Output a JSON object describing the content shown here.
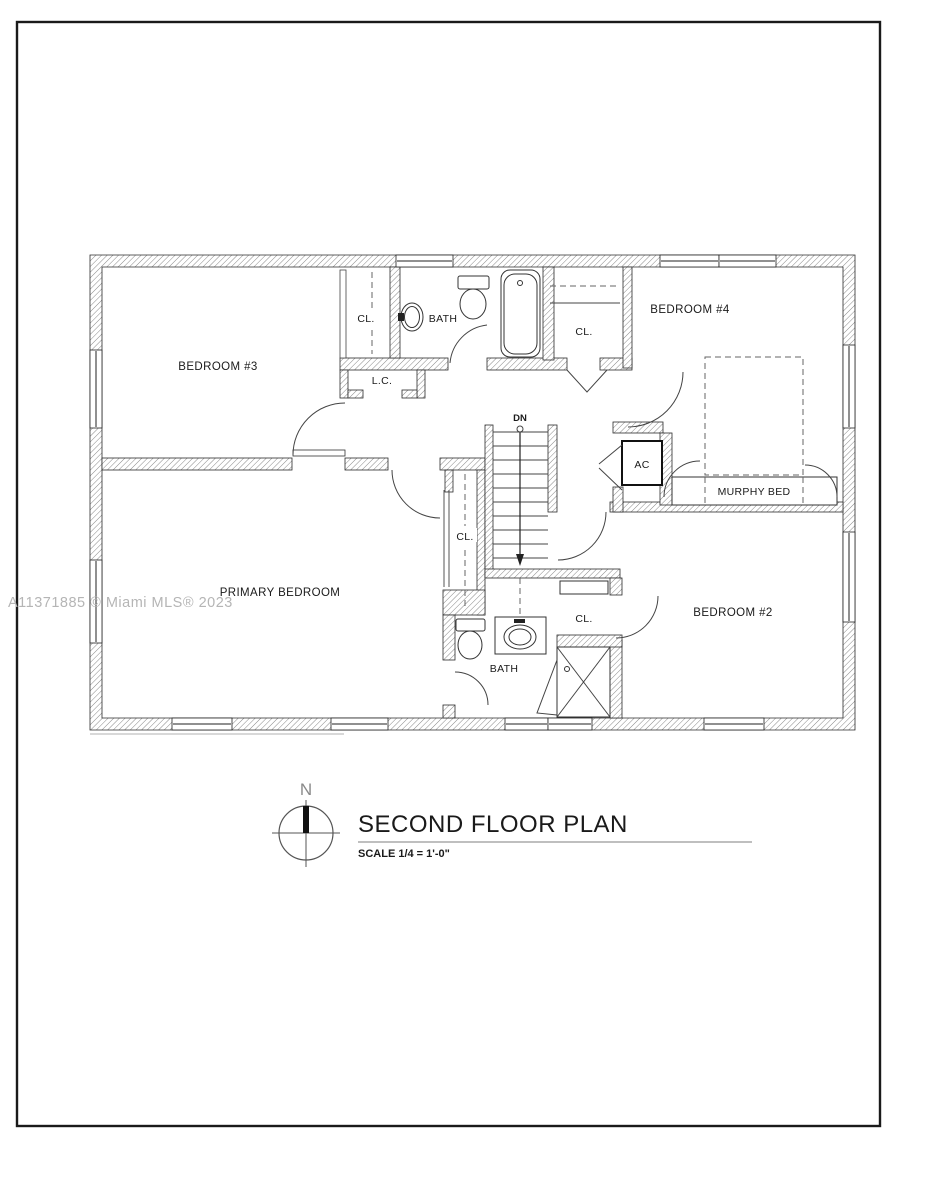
{
  "page": {
    "background": "#ffffff",
    "border_color": "#1a1a1a"
  },
  "plan": {
    "rooms": {
      "bedroom3": "BEDROOM #3",
      "bedroom4": "BEDROOM #4",
      "bedroom2": "BEDROOM #2",
      "primary_bedroom": "PRIMARY BEDROOM",
      "bath_upper": "BATH",
      "bath_lower": "BATH"
    },
    "features": {
      "closet": "CL.",
      "linen_closet": "L.C.",
      "air_conditioner": "AC",
      "stairs_down": "DN",
      "murphy_bed": "MURPHY BED"
    }
  },
  "title_block": {
    "title": "SECOND FLOOR PLAN",
    "scale": "SCALE 1/4 = 1'-0\"",
    "north_label": "N"
  },
  "watermark": {
    "text": "A11371885 © Miami MLS® 2023"
  }
}
